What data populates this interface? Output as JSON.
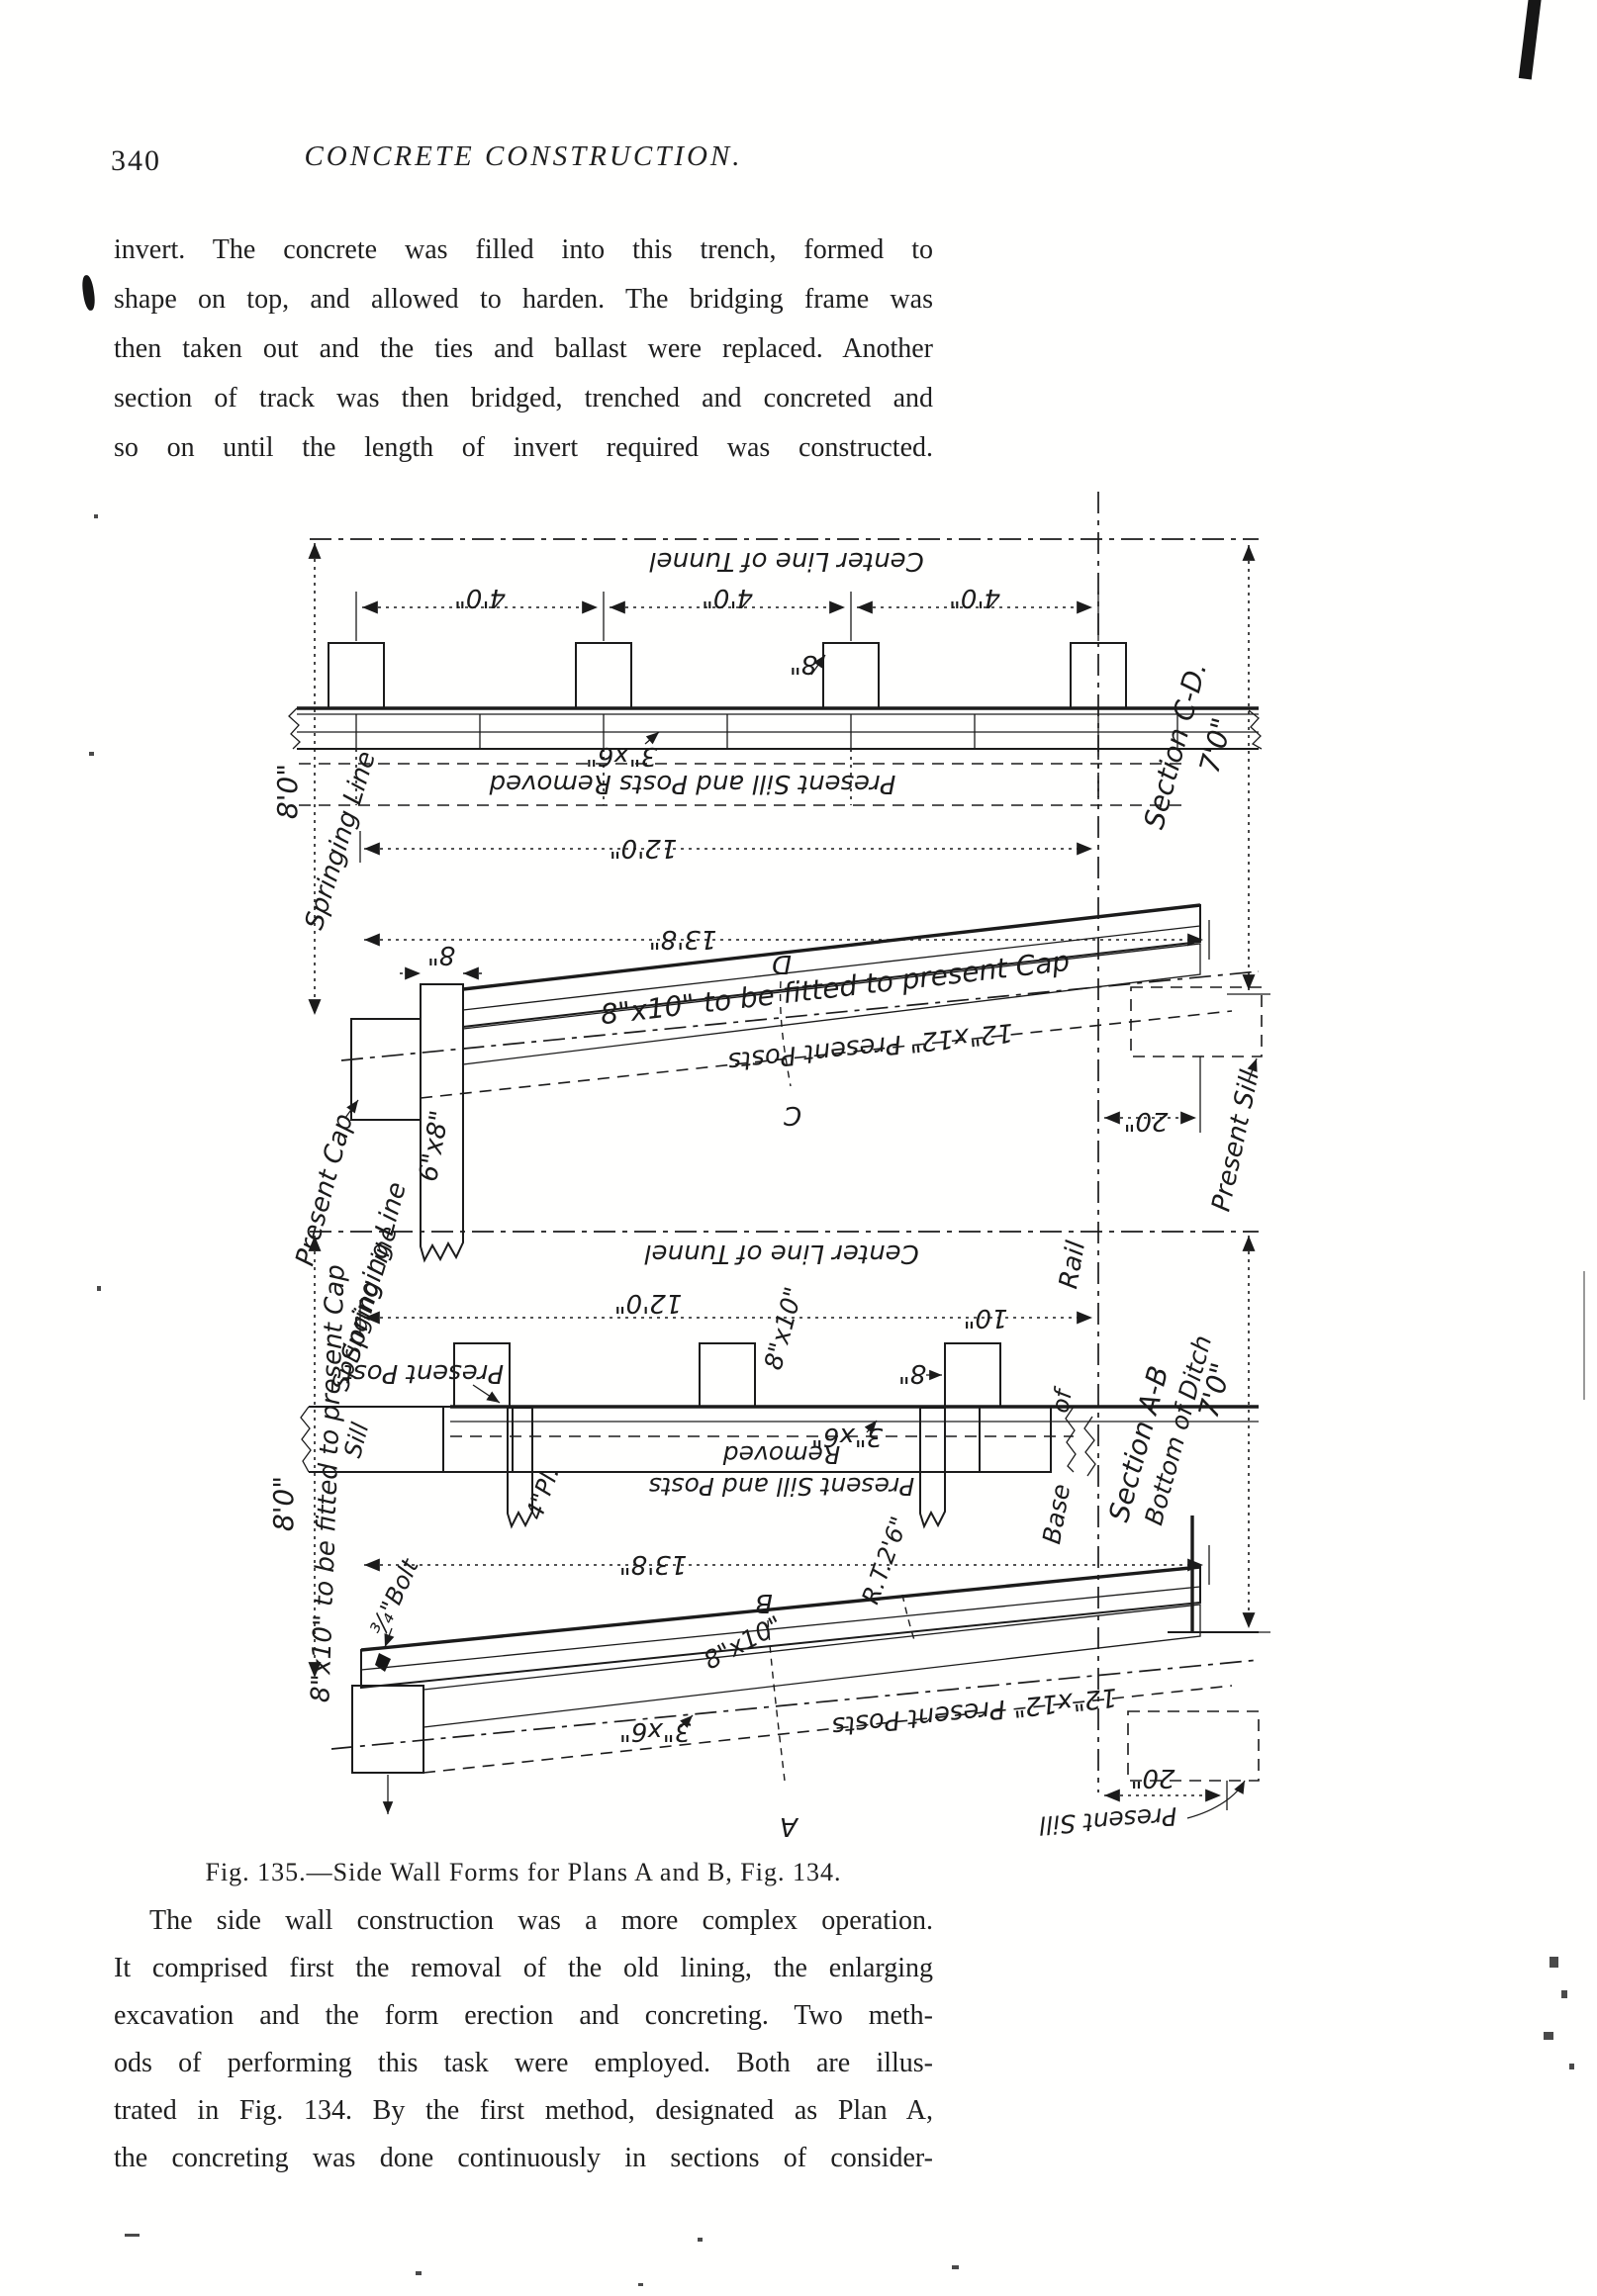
{
  "page": {
    "number": "340",
    "header": "CONCRETE CONSTRUCTION.",
    "para1": {
      "lines": [
        "invert.  The concrete was filled into this trench, formed to",
        "shape on top, and allowed to harden.  The bridging frame was",
        "then taken out and the ties and ballast were replaced.  Another",
        "section of track was then bridged, trenched and concreted and",
        "so on until the length of invert required was constructed."
      ]
    },
    "para2": {
      "lines": [
        "The side wall construction was a more complex operation.",
        "It comprised first the removal of the old lining, the enlarging",
        "excavation and the form erection and concreting.  Two meth-",
        "ods of performing this task were employed.  Both are illus-",
        "trated in Fig. 134.  By the first method, designated as Plan A,",
        "the concreting was done continuously in sections of consider-"
      ]
    }
  },
  "figure": {
    "caption": "Fig. 135.—Side Wall Forms for Plans A and B, Fig. 134.",
    "labels": {
      "center_line": "Center Line of Tunnel",
      "dim_4_0": "4'0\"",
      "dim_8": "8\"",
      "dim_10": "10\"",
      "size_3x6": "3\"x6\"",
      "removed_full": "Present Sill and Posts Removed",
      "removed_l1": "Present Sill and Posts",
      "removed_l2": "Removed",
      "dim_8_0": "8'0\"",
      "springing": "Springing Line",
      "dim_12_0": "12'0\"",
      "dim_13_8": "13'8\"",
      "cap_fit": "8\"x10\" to be fitted to present Cap",
      "size_8x10": "8\"x10\"",
      "letter_D": "D",
      "letter_C": "C",
      "letter_B": "B",
      "letter_A": "A",
      "present_posts": "12\"x12\" Present Posts",
      "present_cap": "Present Cap",
      "size_6x8": "6\"x8\"",
      "section_cd": "Section C-D.",
      "dim_7_0": "7'0\"",
      "dim_20": "20\"",
      "present_sill": "Present Sill",
      "rail": "Rail",
      "word_of": "of",
      "word_base": "Base",
      "present_post": "Present Post",
      "sill": "Sill",
      "plank": "4\"Pl.",
      "bolt": "¾\"Bolt",
      "rt26": "R.T.2'6\"",
      "section_ab": "Section A-B",
      "bottom_ditch": "Bottom of Ditch"
    }
  }
}
